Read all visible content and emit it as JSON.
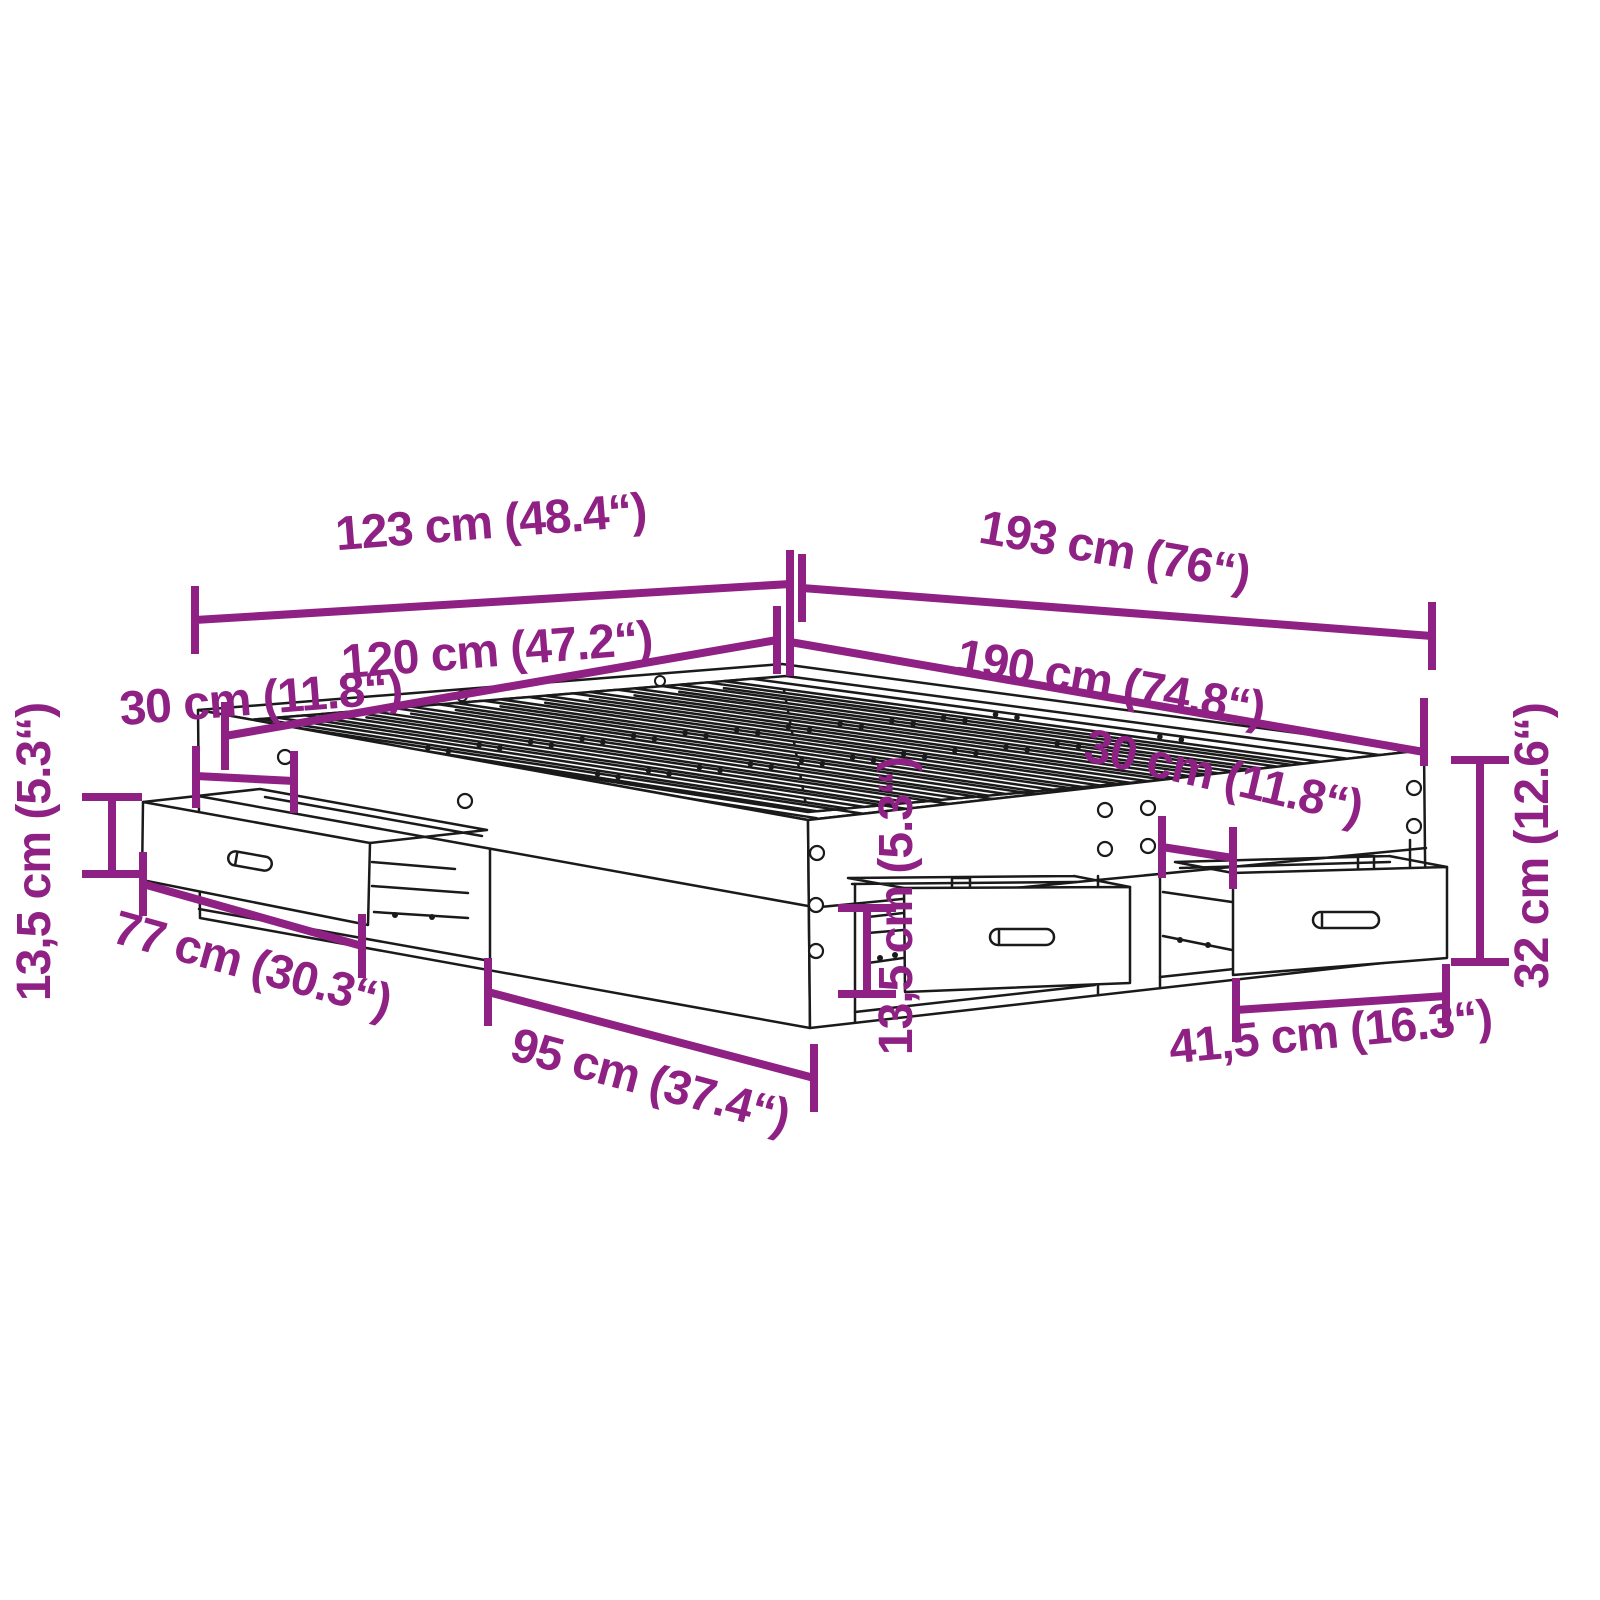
{
  "diagram": {
    "title": "bed-frame-with-drawers-dimension-diagram",
    "accent_color": "#8E2183",
    "line_color": "#1A1A1A",
    "background_color": "#FFFFFF",
    "labels": {
      "outer_width": {
        "text": "123 cm (48.4“)"
      },
      "outer_length": {
        "text": "193 cm (76“)"
      },
      "inner_width": {
        "text": "120 cm (47.2“)"
      },
      "inner_length": {
        "text": "190 cm (74.8“)"
      },
      "head_offset": {
        "text": "30 cm (11.8“)"
      },
      "foot_offset": {
        "text": "30 cm (11.8“)"
      },
      "left_drawer_height": {
        "text": "13,5 cm (5.3“)"
      },
      "left_drawer_width": {
        "text": "77 cm (30.3“)"
      },
      "side_section_width": {
        "text": "95 cm (37.4“)"
      },
      "middle_drawer_height": {
        "text": "13,5 cm (5.3“)"
      },
      "right_drawer_width": {
        "text": "41,5 cm (16.3“)"
      },
      "frame_height": {
        "text": "32 cm (12.6“)"
      }
    }
  }
}
